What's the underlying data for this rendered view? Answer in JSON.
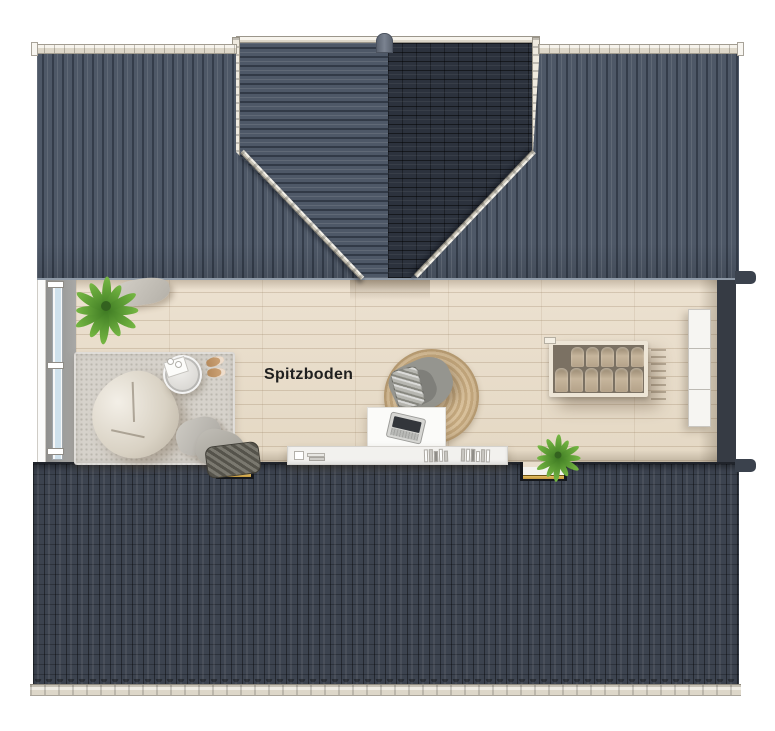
{
  "labels": {
    "room": "Spitzboden"
  },
  "colors": {
    "roof_plane": "#4e5867",
    "roof_gable_dark": "#2c323d",
    "roof_bottom": "#3c434f",
    "gutter": "#ddd7c9",
    "floor_wood": "#e9decd",
    "wall_gray": "#a8a8a6",
    "wall_dark": "#363b44",
    "window_glass": "#cfe1ec",
    "rug_gray": "#d6d2cb",
    "rug_jute": "#c4a87e",
    "beanbag": "#d9d2c4",
    "stair_wood": "#c6b59c",
    "sill_gold": "#c59a3f",
    "plant_green": "#76b844",
    "label_text": "#1f1f1f",
    "furniture_white": "#fbfbf9"
  },
  "elements": [
    "roof-plane-left",
    "roof-plane-right",
    "roof-gable",
    "ridge-cap",
    "roof-valley-left",
    "roof-valley-right",
    "eaves-gutter",
    "wood-floor",
    "window-band",
    "left-wall",
    "right-wall",
    "potted-plant",
    "cushion",
    "area-rug",
    "bean-bag",
    "round-side-table",
    "slippers",
    "jute-rug",
    "armchair",
    "plaid-blanket",
    "desk",
    "laptop",
    "sideboard",
    "books",
    "staircase-opening",
    "wardrobe-cabinet",
    "roof-bottom-section",
    "skylight-notch",
    "roof-gutter-bottom"
  ]
}
